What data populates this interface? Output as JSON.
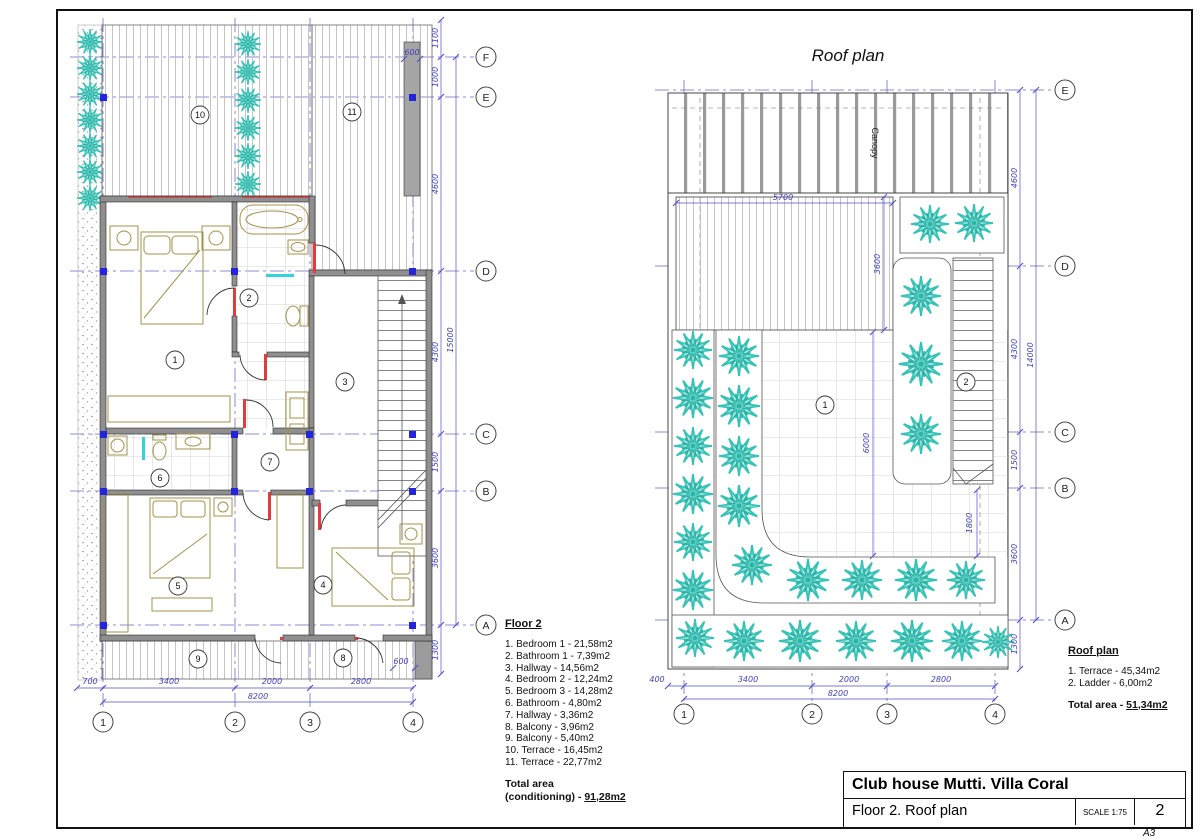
{
  "floor2": {
    "legend": {
      "title": "Floor 2",
      "items": [
        "1. Bedroom 1 - 21,58m2",
        "2. Bathroom 1 - 7,39m2",
        "3. Hallway - 14,56m2",
        "4. Bedroom 2 - 12,24m2",
        "5. Bedroom 3 - 14,28m2",
        "6. Bathroom - 4,80m2",
        "7. Hallway - 3,36m2",
        "8. Balcony - 3,96m2",
        "9. Balcony - 5,40m2",
        "10. Terrace - 16,45m2",
        "11. Terrace - 22,77m2"
      ],
      "total_label": "Total area",
      "total_prefix": "(conditioning) - ",
      "total_value": "91,28m2"
    },
    "rooms": [
      "1",
      "2",
      "3",
      "4",
      "5",
      "6",
      "7",
      "8",
      "9",
      "10",
      "11"
    ],
    "grid_cols": [
      "1",
      "2",
      "3",
      "4"
    ],
    "grid_rows": [
      "F",
      "E",
      "D",
      "C",
      "B",
      "A"
    ],
    "dims_bottom": [
      "700",
      "3400",
      "2000",
      "2800"
    ],
    "dim_total_bottom": "8200",
    "dims_right": [
      "1100",
      "1000",
      "4600",
      "4300",
      "1500",
      "3600",
      "1300"
    ],
    "dim_total_right": "15000",
    "dim_600_top": "600",
    "dim_600_bottom": "600"
  },
  "roof": {
    "title": "Roof plan",
    "canopy": "Canopy",
    "legend": {
      "title": "Roof plan",
      "items": [
        "1. Terrace - 45,34m2",
        "2. Ladder - 6,00m2"
      ],
      "total_label": "Total area - ",
      "total_value": "51,34m2"
    },
    "rooms": [
      "1",
      "2"
    ],
    "grid_cols": [
      "1",
      "2",
      "3",
      "4"
    ],
    "grid_rows": [
      "E",
      "D",
      "C",
      "B",
      "A"
    ],
    "dims_bottom": [
      "400",
      "3400",
      "2000",
      "2800"
    ],
    "dim_total_bottom": "8200",
    "dims_right": [
      "4600",
      "4300",
      "1500",
      "3600",
      "1300"
    ],
    "dim_total_right": "14000",
    "dim_width": "5700",
    "dim_height": "3600",
    "dim_terrace": "6000",
    "dim_stair": "1800"
  },
  "title_block": {
    "project": "Club house Mutti. Villa Coral",
    "sheet_title": "Floor 2. Roof plan",
    "scale_label": "SCALE",
    "scale_value": "1:75",
    "sheet_number": "2",
    "paper": "A3"
  },
  "colors": {
    "accent_blue": "#4040c0",
    "teal": "#35c3b6",
    "wall_gray": "#8f8f8f",
    "furniture_olive": "#a3924a",
    "door_red": "#e23b3b"
  }
}
